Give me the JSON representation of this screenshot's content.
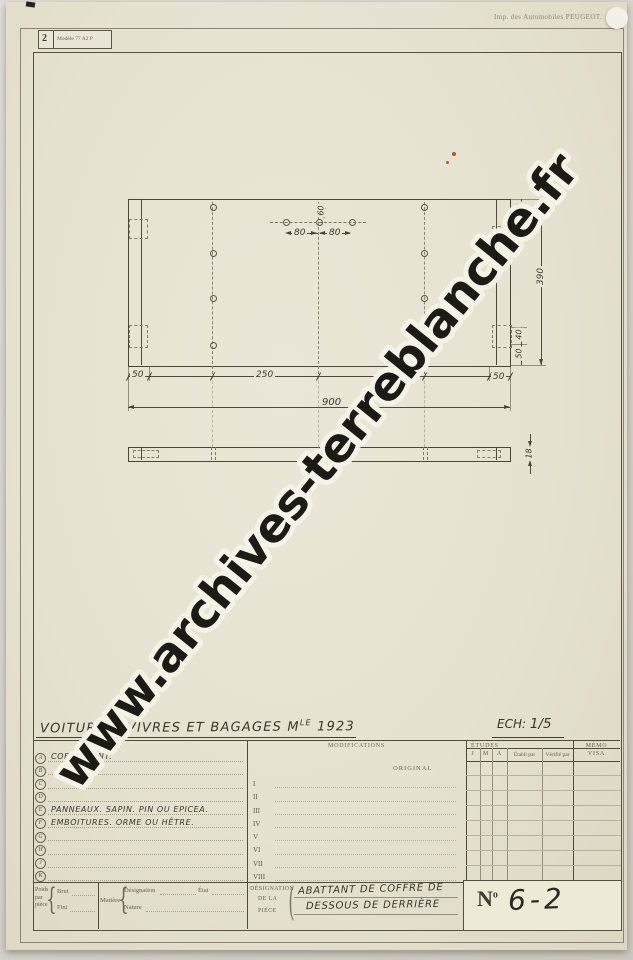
{
  "page": {
    "stamp_number": "2",
    "stamp_model": "Modèle 77 A2 P",
    "imprint": "Imp. des Automobiles PEUGEOT.",
    "watermark": "www.archives-terreblanche.fr"
  },
  "title": {
    "main": "VOITURE A VIVRES ET BAGAGES M",
    "model_sup": "LE",
    "year": "1923",
    "scale_label": "ECH:",
    "scale_value": "1/5"
  },
  "drawing": {
    "dim_top_edge": "60",
    "dim_hole_spacing_1": "80",
    "dim_hole_spacing_2": "80",
    "dim_height_total": "390",
    "dim_right_top_1": "50",
    "dim_right_top_2": "40",
    "dim_right_bottom_1": "40",
    "dim_right_bottom_2": "50",
    "dim_bottom_1": "50",
    "dim_bottom_2": "250",
    "dim_bottom_3": "250",
    "dim_bottom_4": "50",
    "dim_width_total": "900",
    "dim_thickness": "18"
  },
  "legend": {
    "header": "LÉGENDE",
    "rows": [
      {
        "letter": "A",
        "text": "COEFFICIENT:"
      },
      {
        "letter": "B",
        "text": ""
      },
      {
        "letter": "C",
        "text": ""
      },
      {
        "letter": "D",
        "text": ""
      },
      {
        "letter": "E",
        "text": "PANNEAUX.  SAPIN. PIN  OU EPICEA."
      },
      {
        "letter": "F",
        "text": "EMBOITURES.  ORME  OU  HÊTRE."
      },
      {
        "letter": "G",
        "text": ""
      },
      {
        "letter": "H",
        "text": ""
      },
      {
        "letter": "J",
        "text": ""
      },
      {
        "letter": "K",
        "text": ""
      }
    ]
  },
  "modifications": {
    "header": "MODIFICATIONS",
    "original": "ORIGINAL",
    "rows": [
      "I",
      "II",
      "III",
      "IV",
      "V",
      "VI",
      "VII",
      "VIII"
    ]
  },
  "etudes": {
    "header": "ÉTUDES",
    "columns": [
      "J",
      "M",
      "A",
      "Établi par",
      "Vérifié par"
    ]
  },
  "memo": {
    "header": "MÉMO",
    "visa": "VISA"
  },
  "weights": {
    "w1": "Poids",
    "w2": "par",
    "w3": "pièce",
    "brut": "Brut",
    "fini": "Fini",
    "matiere": "Matière",
    "designation": "Désignation",
    "etat": "État",
    "nature": "Nature"
  },
  "piece": {
    "label1": "DÉSIGNATION",
    "label2": "DE LA",
    "label3": "PIÈCE",
    "line1": "ABATTANT DE COFFRE DE",
    "line2": "DESSOUS DE DERRIÈRE",
    "num_n": "N",
    "num_sup": "o",
    "num_value": "6-2"
  },
  "glyphs": {
    "brace": "{",
    "paren": "("
  }
}
